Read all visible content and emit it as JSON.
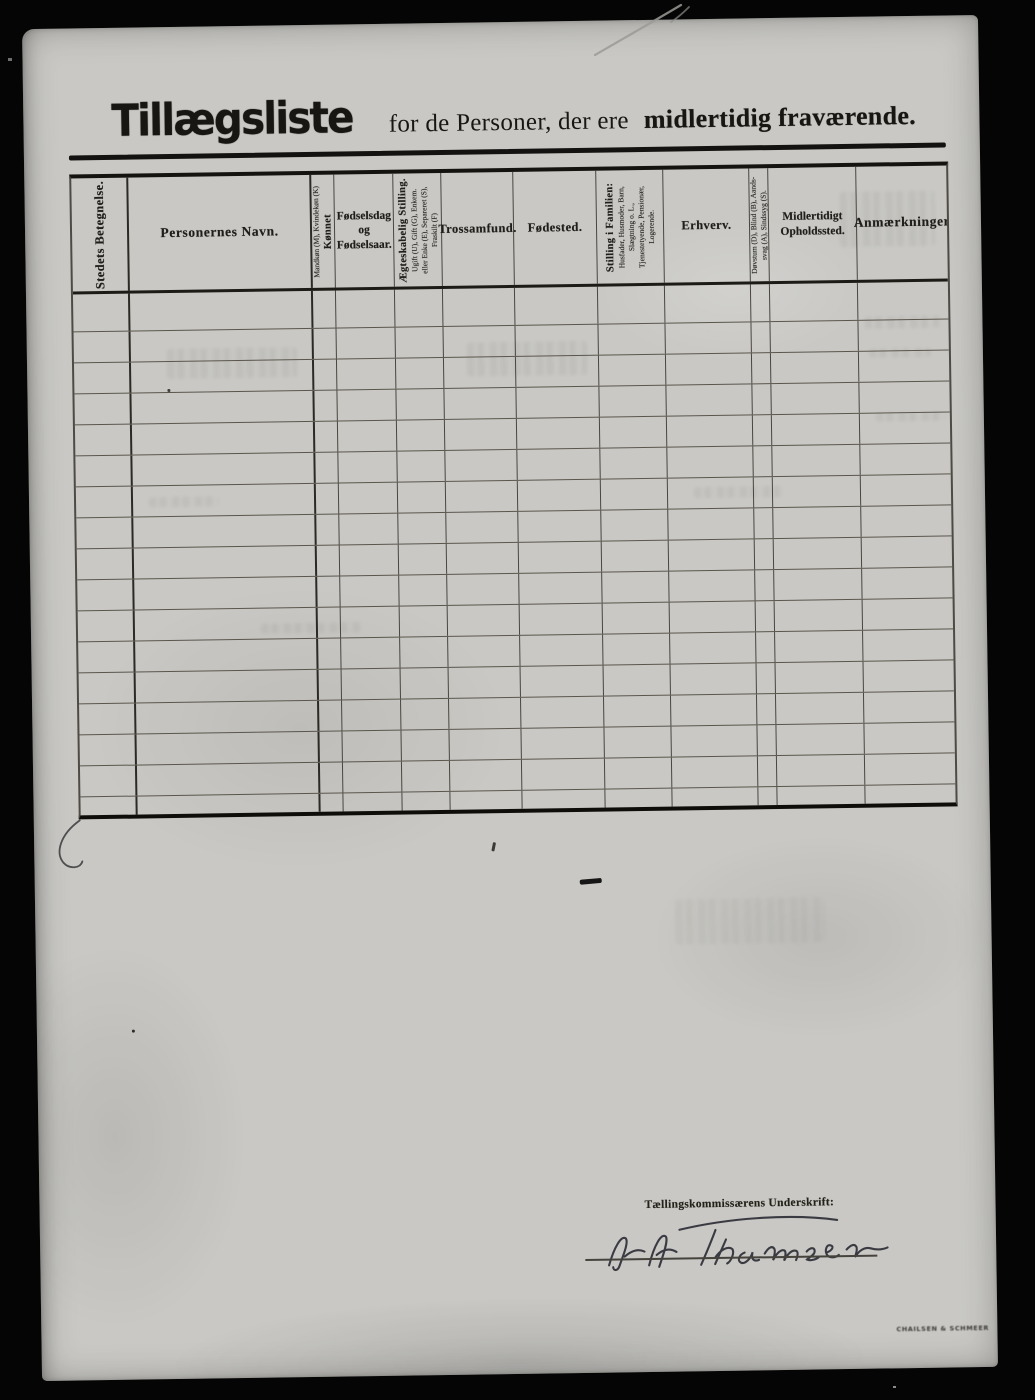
{
  "title": {
    "main": "Tillægsliste",
    "middle": "for de Personer, der ere",
    "emphasis": "midlertidig fraværende."
  },
  "table": {
    "columns": [
      {
        "name": "stedets-betegnelse",
        "orientation": "rotated",
        "width": 57,
        "lines": [
          {
            "text": "Stedets Betegnelse.",
            "style": "label"
          }
        ]
      },
      {
        "name": "personernes-navn",
        "orientation": "horizontal",
        "width": 183,
        "lines": [
          {
            "text": "Personernes Navn.",
            "style": "label-lg"
          }
        ]
      },
      {
        "name": "koennet",
        "orientation": "rotated",
        "width": 23,
        "lines": [
          {
            "text": "Mandkøn (M), Kvindekøn (K)",
            "style": "tiny"
          },
          {
            "text": "Kønnet",
            "style": "label-sm"
          }
        ]
      },
      {
        "name": "foedselsdag",
        "orientation": "horizontal",
        "width": 59,
        "lines": [
          {
            "text": "Fødselsdag",
            "style": "mid"
          },
          {
            "text": "og",
            "style": "mid"
          },
          {
            "text": "Fødselsaar.",
            "style": "mid"
          }
        ]
      },
      {
        "name": "aegteskabelig-stilling",
        "orientation": "rotated",
        "width": 48,
        "lines": [
          {
            "text": "Ægteskabelig Stilling.",
            "style": "label-sm"
          },
          {
            "text": "Ugift (U), Gift (G), Enkem.",
            "style": "tiny"
          },
          {
            "text": "eller Enke (E), Separeret (S),",
            "style": "tiny"
          },
          {
            "text": "Fraskilt (F)",
            "style": "tiny"
          }
        ]
      },
      {
        "name": "trossamfund",
        "orientation": "horizontal",
        "width": 72,
        "lines": [
          {
            "text": "Trossamfund.",
            "style": "label"
          }
        ]
      },
      {
        "name": "foedested",
        "orientation": "horizontal",
        "width": 83,
        "lines": [
          {
            "text": "Fødested.",
            "style": "label"
          }
        ]
      },
      {
        "name": "stilling-i-familien",
        "orientation": "rotated",
        "width": 67,
        "lines": [
          {
            "text": "Stilling i Familien:",
            "style": "label-sm"
          },
          {
            "text": "Husfader, Husmoder, Barn,",
            "style": "tiny"
          },
          {
            "text": "Slægtning o. L.,",
            "style": "tiny"
          },
          {
            "text": "Tjenestetyende, Pensionær,",
            "style": "tiny"
          },
          {
            "text": "Logerende.",
            "style": "tiny"
          }
        ]
      },
      {
        "name": "erhverv",
        "orientation": "horizontal",
        "width": 86,
        "lines": [
          {
            "text": "Erhverv.",
            "style": "label"
          }
        ]
      },
      {
        "name": "doevstum",
        "orientation": "rotated",
        "width": 19,
        "lines": [
          {
            "text": "Døvstum (D), Blind (B), Aands-",
            "style": "tiny"
          },
          {
            "text": "svag (A), Sindssyg (S).",
            "style": "tiny"
          }
        ]
      },
      {
        "name": "midlertidigt-opholdssted",
        "orientation": "horizontal",
        "width": 88,
        "lines": [
          {
            "text": "Midlertidigt",
            "style": "mid"
          },
          {
            "text": "Opholdssted.",
            "style": "mid"
          }
        ]
      },
      {
        "name": "anmaerkninger",
        "orientation": "horizontal",
        "width": 90,
        "lines": [
          {
            "text": "Anmærkninger",
            "style": "label-lg"
          }
        ]
      }
    ],
    "row_heights": [
      38,
      31,
      31,
      31,
      31,
      31,
      31,
      31,
      31,
      31,
      31,
      31,
      31,
      31,
      31,
      31,
      18
    ]
  },
  "signature": {
    "label": "Tællingskommissærens Underskrift:",
    "name": "H H Thomsen"
  },
  "printer_mark": "Chailsen & Schmeer"
}
